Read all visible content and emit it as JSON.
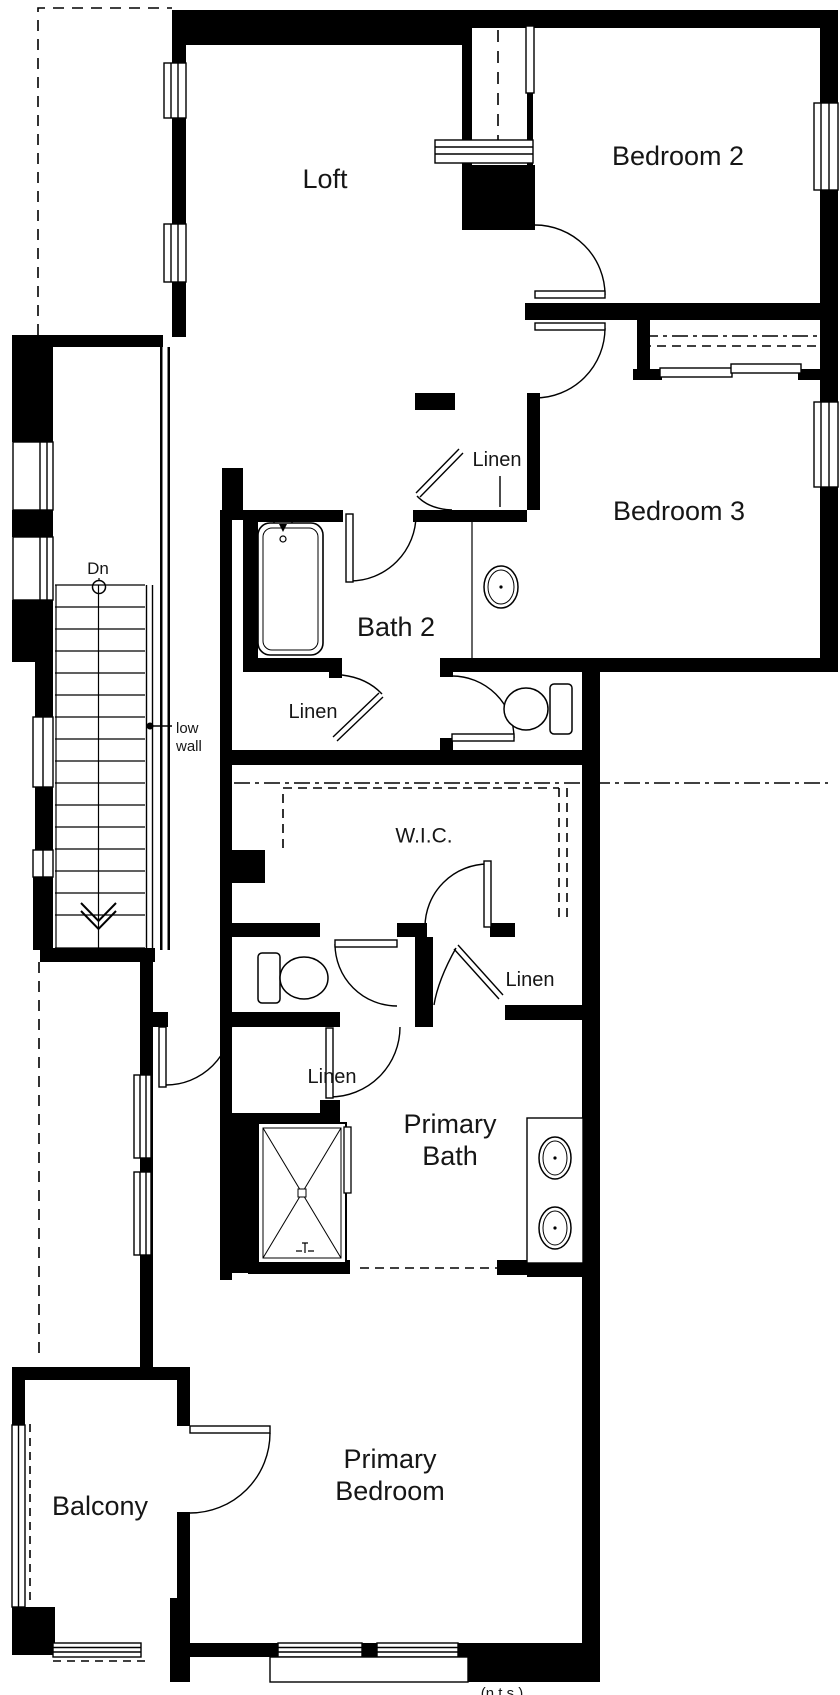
{
  "rooms": {
    "loft": "Loft",
    "bedroom2": "Bedroom 2",
    "bedroom3": "Bedroom 3",
    "bath2": "Bath 2",
    "wic": "W.I.C.",
    "primary_bath_1": "Primary",
    "primary_bath_2": "Bath",
    "primary_bedroom_1": "Primary",
    "primary_bedroom_2": "Bedroom",
    "balcony": "Balcony"
  },
  "closets": {
    "linen_top": "Linen",
    "linen_mid": "Linen",
    "linen_right": "Linen",
    "linen_lower": "Linen"
  },
  "annotations": {
    "stairs_down": "Dn",
    "low_wall_1": "low",
    "low_wall_2": "wall",
    "clipped_caption": "(n.t.s.)"
  },
  "colors": {
    "line": "#000000",
    "background": "#ffffff"
  }
}
